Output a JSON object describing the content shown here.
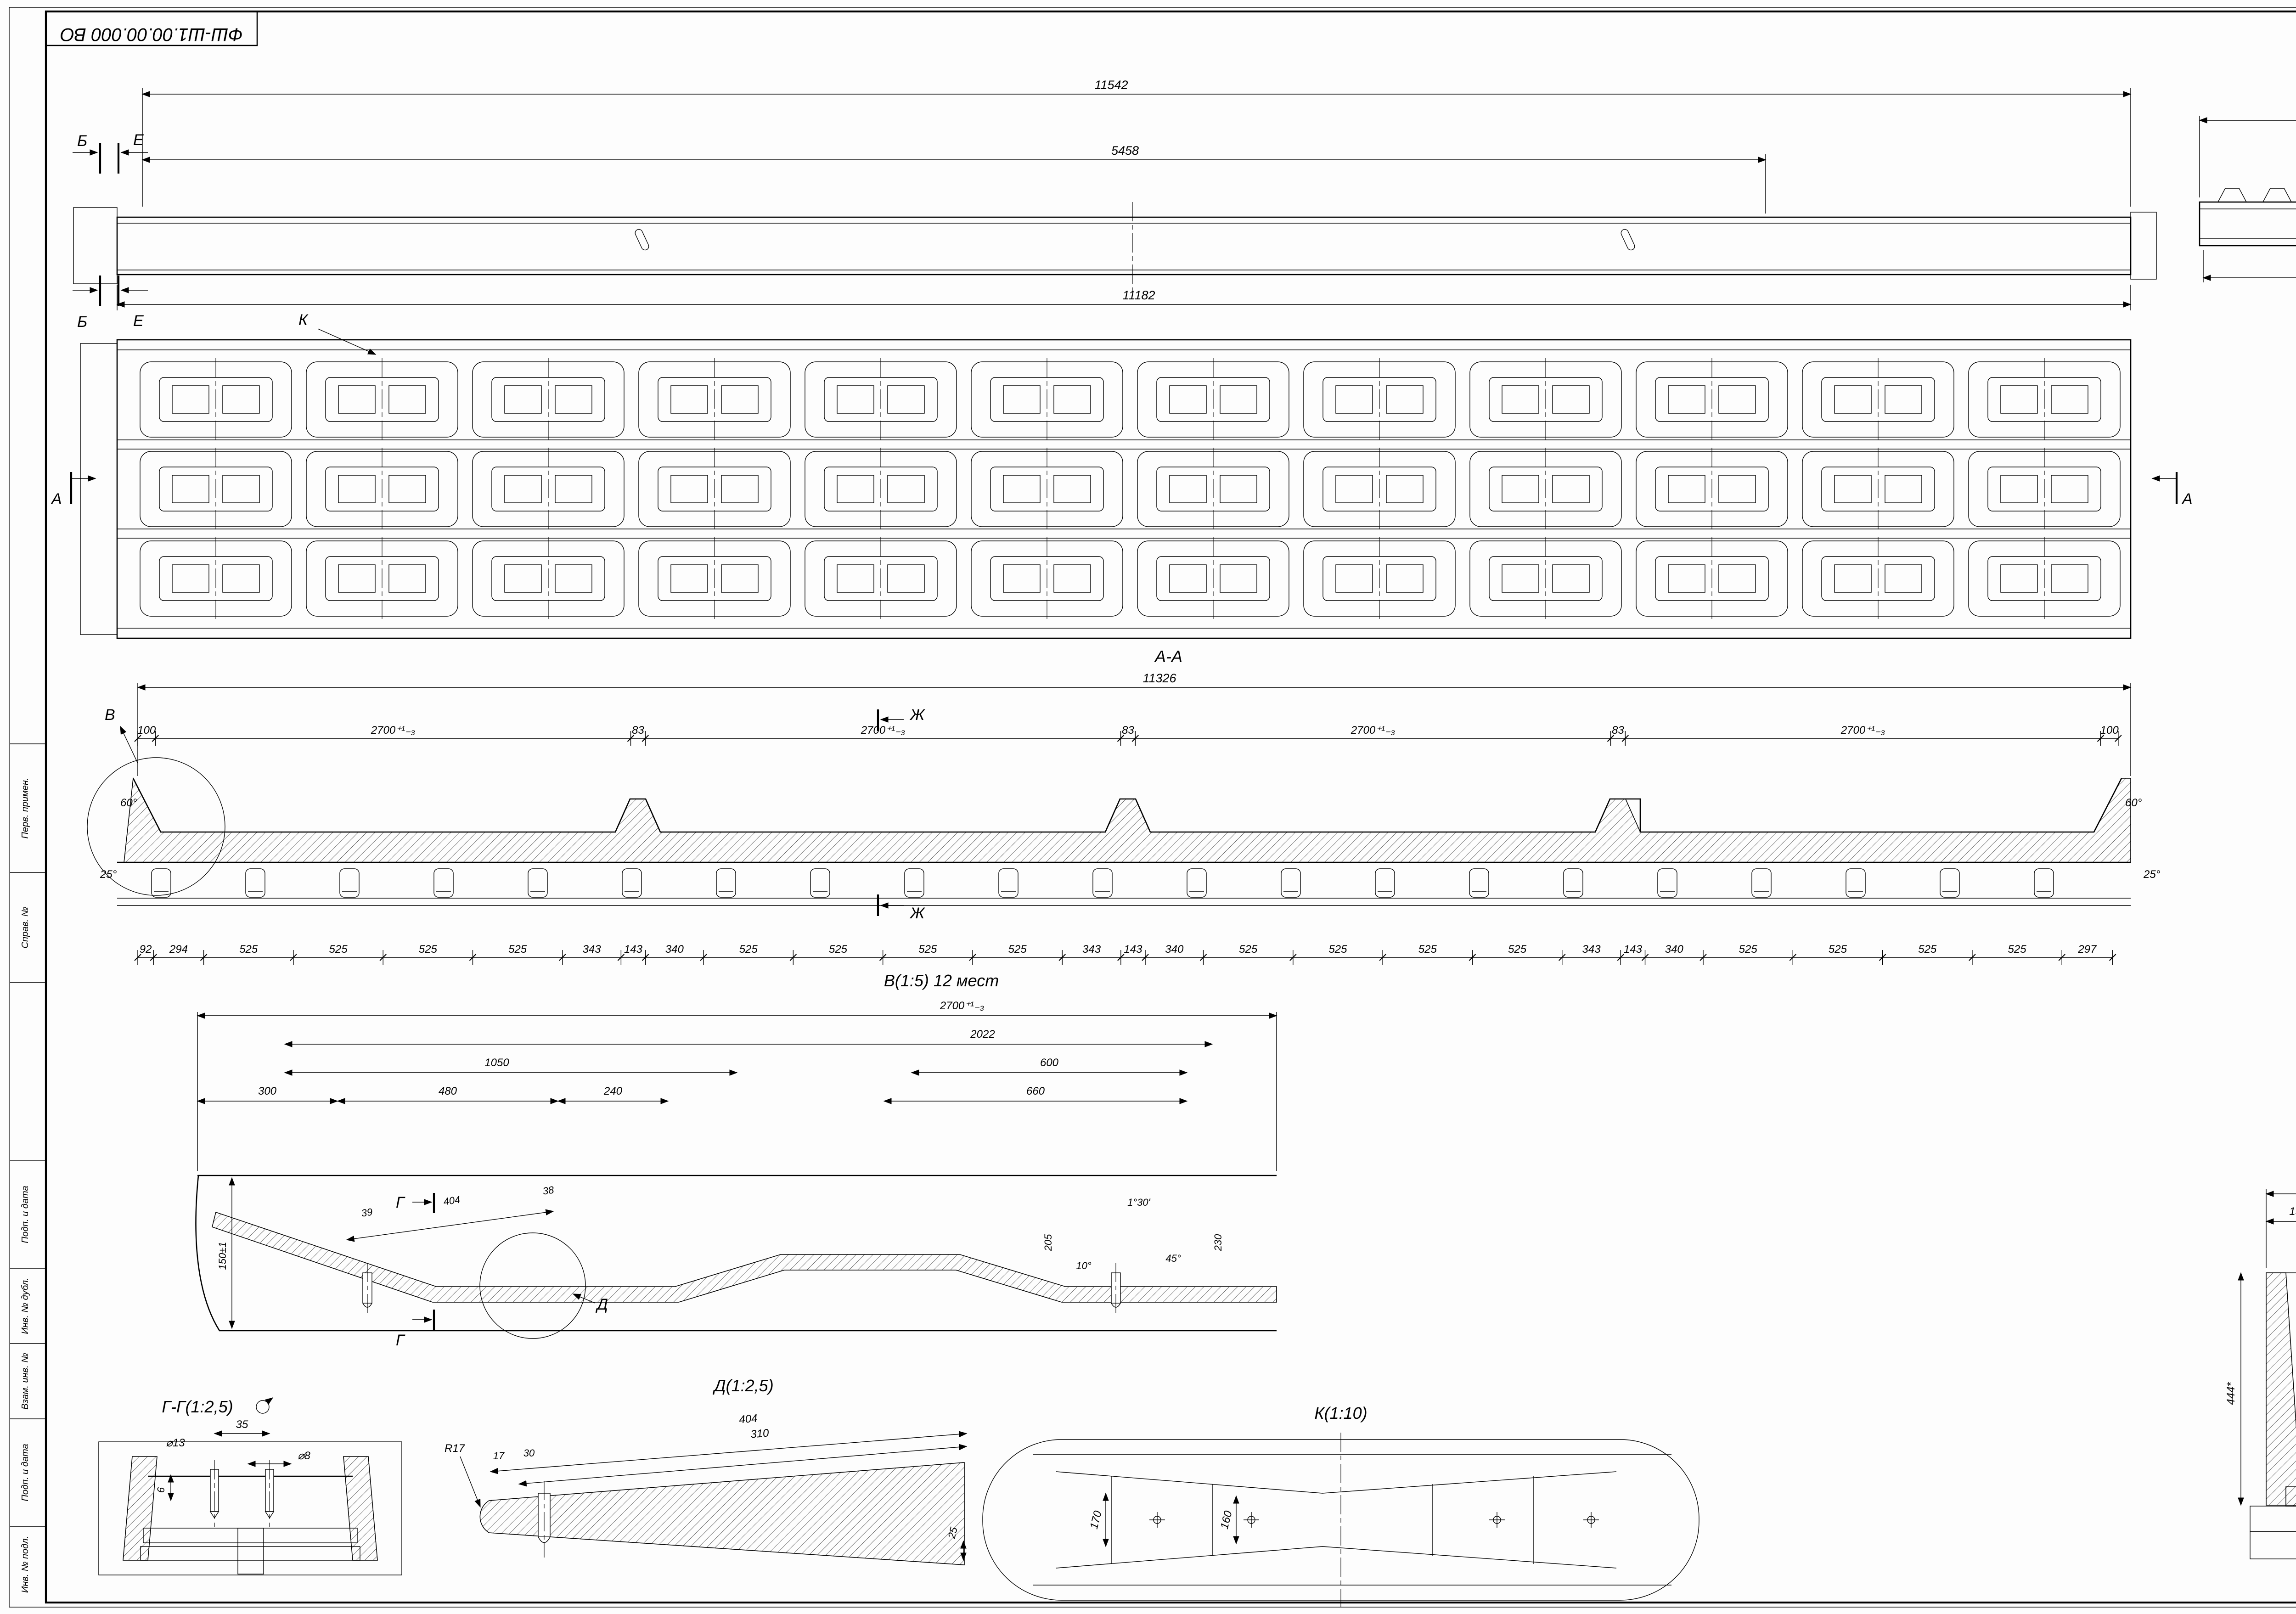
{
  "page": {
    "corner_doc_number": "ФШ-Ш1.00.00.000 ВО",
    "copied_label": "Копировал",
    "format_label": "Формат",
    "format_value": "А2х3"
  },
  "side_strip": {
    "labels": [
      "Перв. примен.",
      "Справ. №",
      "Подп. и дата",
      "Инв. № дубл.",
      "Взам. инв. №",
      "Подп. и дата",
      "Инв. № подл."
    ]
  },
  "front_view": {
    "dim_top": "11542",
    "dim_mid": "5458",
    "dim_bottom": "11182",
    "mark_b": "Б",
    "mark_e": "Е"
  },
  "plan_view": {
    "callout_k": "К",
    "mark_a": "А"
  },
  "section_aa": {
    "title": "А-А",
    "dim_total": "11326",
    "angle_60": "60°",
    "angle_25": "25°",
    "mark_v": "В",
    "mark_zh": "Ж",
    "top_chain": [
      {
        "label": "100",
        "mm": 100
      },
      {
        "label": "2700⁺¹₋₃",
        "mm": 2700
      },
      {
        "label": "83",
        "mm": 83
      },
      {
        "label": "2700⁺¹₋₃",
        "mm": 2700
      },
      {
        "label": "83",
        "mm": 83
      },
      {
        "label": "2700⁺¹₋₃",
        "mm": 2700
      },
      {
        "label": "83",
        "mm": 83
      },
      {
        "label": "2700⁺¹₋₃",
        "mm": 2700
      },
      {
        "label": "100",
        "mm": 100
      }
    ],
    "bottom_chain": [
      {
        "label": "92",
        "mm": 92
      },
      {
        "label": "294",
        "mm": 294
      },
      {
        "label": "525",
        "mm": 525
      },
      {
        "label": "525",
        "mm": 525
      },
      {
        "label": "525",
        "mm": 525
      },
      {
        "label": "525",
        "mm": 525
      },
      {
        "label": "343",
        "mm": 343
      },
      {
        "label": "143",
        "mm": 143
      },
      {
        "label": "340",
        "mm": 340
      },
      {
        "label": "525",
        "mm": 525
      },
      {
        "label": "525",
        "mm": 525
      },
      {
        "label": "525",
        "mm": 525
      },
      {
        "label": "525",
        "mm": 525
      },
      {
        "label": "343",
        "mm": 343
      },
      {
        "label": "143",
        "mm": 143
      },
      {
        "label": "340",
        "mm": 340
      },
      {
        "label": "525",
        "mm": 525
      },
      {
        "label": "525",
        "mm": 525
      },
      {
        "label": "525",
        "mm": 525
      },
      {
        "label": "525",
        "mm": 525
      },
      {
        "label": "343",
        "mm": 343
      },
      {
        "label": "143",
        "mm": 143
      },
      {
        "label": "340",
        "mm": 340
      },
      {
        "label": "525",
        "mm": 525
      },
      {
        "label": "525",
        "mm": 525
      },
      {
        "label": "525",
        "mm": 525
      },
      {
        "label": "525",
        "mm": 525
      },
      {
        "label": "297",
        "mm": 297
      }
    ]
  },
  "end_view": {
    "dim_top": "1592",
    "dim_bottom": "1576"
  },
  "detail_ii": {
    "title": "И-И(1:2,5)",
    "dim_60": "60*",
    "dim_12": "12*"
  },
  "section_bb": {
    "title": "Б-Б(1:5)",
    "dim_130": "130",
    "mark_i": "И"
  },
  "section_zhzh": {
    "title": "Ж-Ж(1:5)",
    "dim_250": "250±1",
    "dim_182": "182",
    "by_radius": "по радиусу",
    "dim_178": "178±1",
    "r10": "R10"
  },
  "section_ee": {
    "title": "Е-Е(1:5)",
    "dim_1576": "1576",
    "dim_154": "154*",
    "dim_434": "434",
    "dim_300": "300±1",
    "dim_225": "225±1",
    "dim_150": "150±1",
    "dim_125": "125*",
    "dim_444": "444*",
    "angle_60": "60°",
    "angle_109": "109°"
  },
  "view_v": {
    "title": "В(1:5) 12 мест",
    "dim_2700": "2700⁺¹₋₃",
    "dim_2022": "2022",
    "dim_1050": "1050",
    "dim_600": "600",
    "dim_660": "660",
    "dim_300": "300",
    "dim_480": "480",
    "dim_240": "240",
    "dim_39": "39",
    "dim_404": "404",
    "dim_38": "38",
    "dim_150": "150±1",
    "dim_205": "205",
    "dim_230": "230",
    "angle_130": "1°30'",
    "angle_10": "10°",
    "angle_45": "45°",
    "mark_g": "Г",
    "mark_d": "Д"
  },
  "detail_gg": {
    "title": "Г-Г(1:2,5)",
    "dim_35": "35",
    "dim_d13": "⌀13",
    "dim_d8": "⌀8",
    "dim_6": "6"
  },
  "detail_dd": {
    "title": "Д(1:2,5)",
    "dim_404": "404",
    "dim_310": "310",
    "dim_17": "17",
    "dim_30": "30",
    "r17": "R17"
  },
  "detail_kk": {
    "title": "К(1:10)",
    "dim_170": "170",
    "dim_160": "160",
    "dim_25": "25"
  },
  "notes": [
    "1  Неуказанные предельные отклонения Н14, h14, ± IT14/2, класс точности 5 ГОСТ 25781-83.",
    "2  *Размер для справок.",
    "3  Радиус R10 по контуру изделия формировать с помощью сварочного шва.",
    "4  Сварка по ГОСТ 14771-76 и ГОСТ 23518-79. Допускается ГОСТ 5264-80 и ГОСТ 11534-75",
    "соответственно. Брызги убрать.",
    "5  Консервация формующих поверхностей минеральным маслом. Допускается Литол-24 ГОСТ",
    "21150-87, солидол синтетический ГОСТ 4366-76, К-17 ГОСТ 10887-75.",
    "6  Покрытие изделия грунт ГФ-021 ГОСТ 25129-82 эмаль ПФ-115 ГОСТ 6465-76. Формующие",
    "поверхности не покрывать."
  ],
  "title_block": {
    "doc_number": "ФШ-Ш1.00.00.000 ВО",
    "product_name": "Форма шпалы Ш1",
    "doc_type": "Чертеж общего вида",
    "lit_label": "Лит.",
    "mass_label": "Масса",
    "scale_label": "Масштаб",
    "mass_value": "5178,7",
    "scale_value": "1:15",
    "sheet_label": "Лист",
    "sheets_label": "Листов",
    "sheets_value": "1",
    "header": {
      "izm": "Изм.",
      "list": "Лист",
      "doc": "№ докум.",
      "podp": "Подп.",
      "data": "Дата"
    },
    "rows": [
      "Разраб.",
      "Пров.",
      "Т.контр.",
      "Н.контр.",
      "Утв."
    ]
  }
}
